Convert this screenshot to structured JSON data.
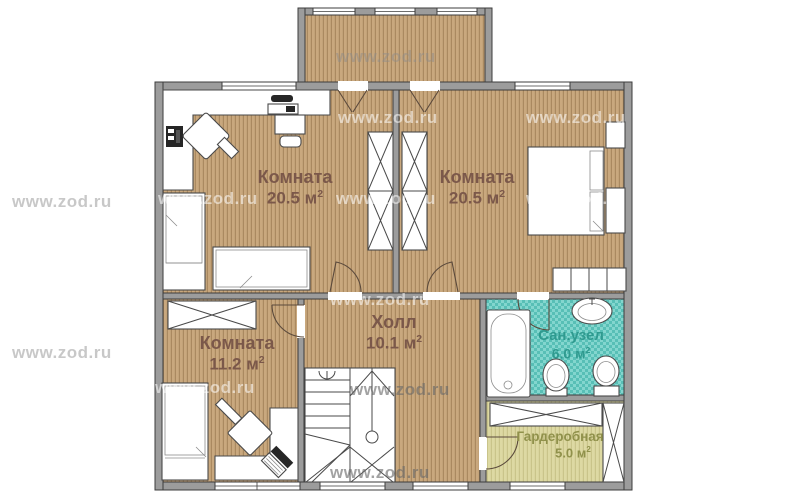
{
  "watermark": {
    "text": "www.zod.ru"
  },
  "rooms": [
    {
      "id": "room-top-left",
      "name": "Комната",
      "area": "20.5 м",
      "sup": "2"
    },
    {
      "id": "room-top-right",
      "name": "Комната",
      "area": "20.5 м",
      "sup": "2"
    },
    {
      "id": "room-bottom-left",
      "name": "Комната",
      "area": "11.2 м",
      "sup": "2"
    },
    {
      "id": "hall",
      "name": "Холл",
      "area": "10.1 м",
      "sup": "2"
    },
    {
      "id": "bathroom",
      "name": "Сан.узел",
      "area": "6.0 м",
      "sup": "2"
    },
    {
      "id": "dressing-room",
      "name": "Гардеробная",
      "area": "5.0 м",
      "sup": "2"
    }
  ],
  "colors": {
    "wall": "#9c9c9c",
    "line": "#3d3d3d",
    "wood-floor": "#c9a87e",
    "wood-stripe": "#aa8960",
    "tile-base": "#83d6ce",
    "tile-dark": "#58bfb6",
    "khaki-floor": "#ddd9a3",
    "khaki-stripe": "#c9c48a",
    "label-room": "#7b584a",
    "label-bath": "#2f9a8f",
    "label-dress": "#90914b"
  }
}
